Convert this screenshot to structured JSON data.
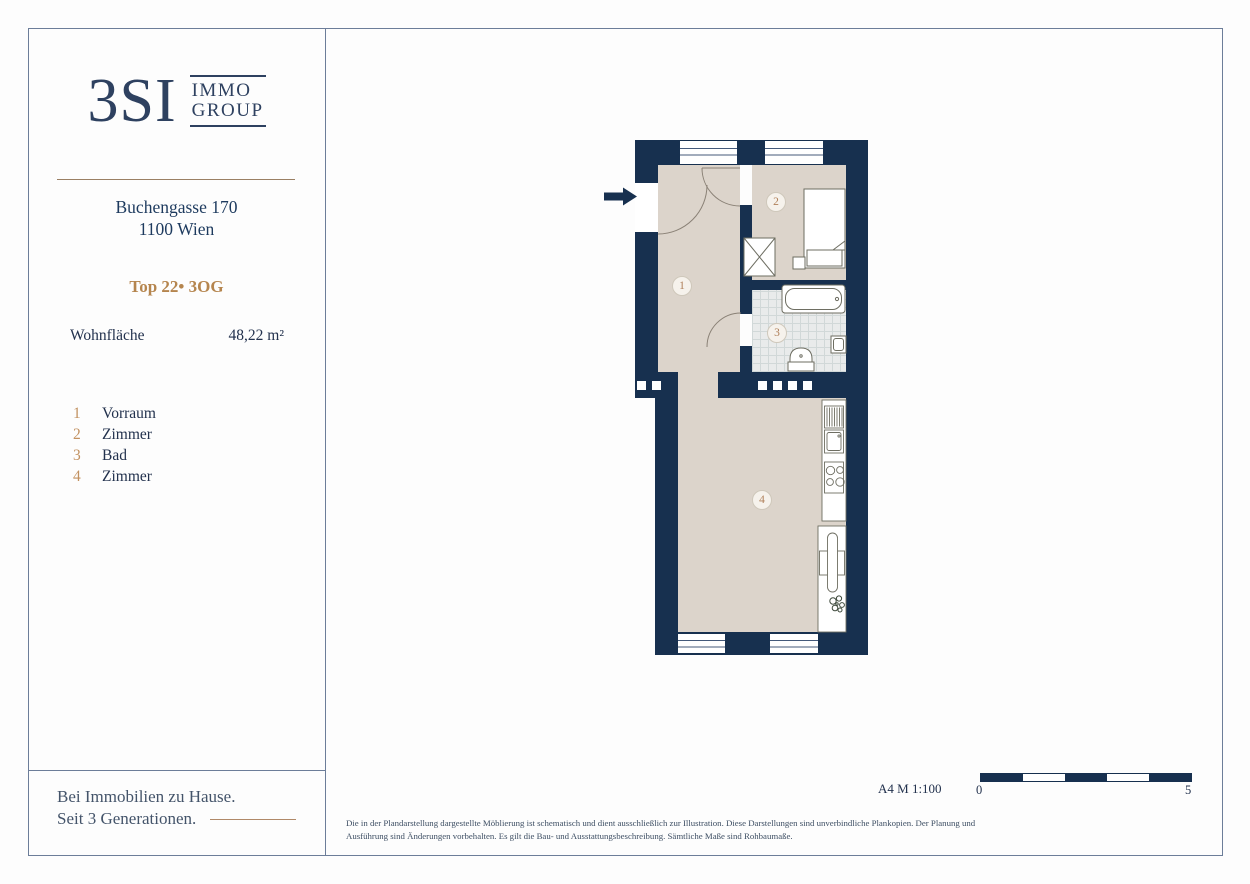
{
  "brand": {
    "logo_main": "3SI",
    "logo_word1": "IMMO",
    "logo_word2": "GROUP"
  },
  "property": {
    "address_line1": "Buchengasse 170",
    "address_line2": "1100 Wien",
    "unit_label": "Top 22• 3OG",
    "area_label": "Wohnfläche",
    "area_value": "48,22 m²"
  },
  "legend": {
    "items": [
      {
        "num": "1",
        "label": "Vorraum"
      },
      {
        "num": "2",
        "label": "Zimmer"
      },
      {
        "num": "3",
        "label": "Bad"
      },
      {
        "num": "4",
        "label": "Zimmer"
      }
    ]
  },
  "plan": {
    "room_numbers": [
      "1",
      "2",
      "3",
      "4"
    ]
  },
  "footer": {
    "tagline_line1": "Bei Immobilien zu Hause.",
    "tagline_line2": "Seit 3 Generationen.",
    "format_scale": "A4  M 1:100",
    "scale_start": "0",
    "scale_end": "5",
    "disclaimer": "Die in der Plandarstellung dargestellte Möblierung ist schematisch und dient ausschließlich zur Illustration. Diese Darstellungen sind unverbindliche Plankopien. Der Planung und Ausführung sind Änderungen vorbehalten. Es gilt die Bau- und Ausstattungsbeschreibung. Sämtliche Maße sind Rohbaumaße."
  },
  "colors": {
    "navy": "#1d3a5e",
    "wall": "#17304f",
    "gold": "#b5854e",
    "beige": "#dcd4cb",
    "tile": "#e9ebeb"
  }
}
